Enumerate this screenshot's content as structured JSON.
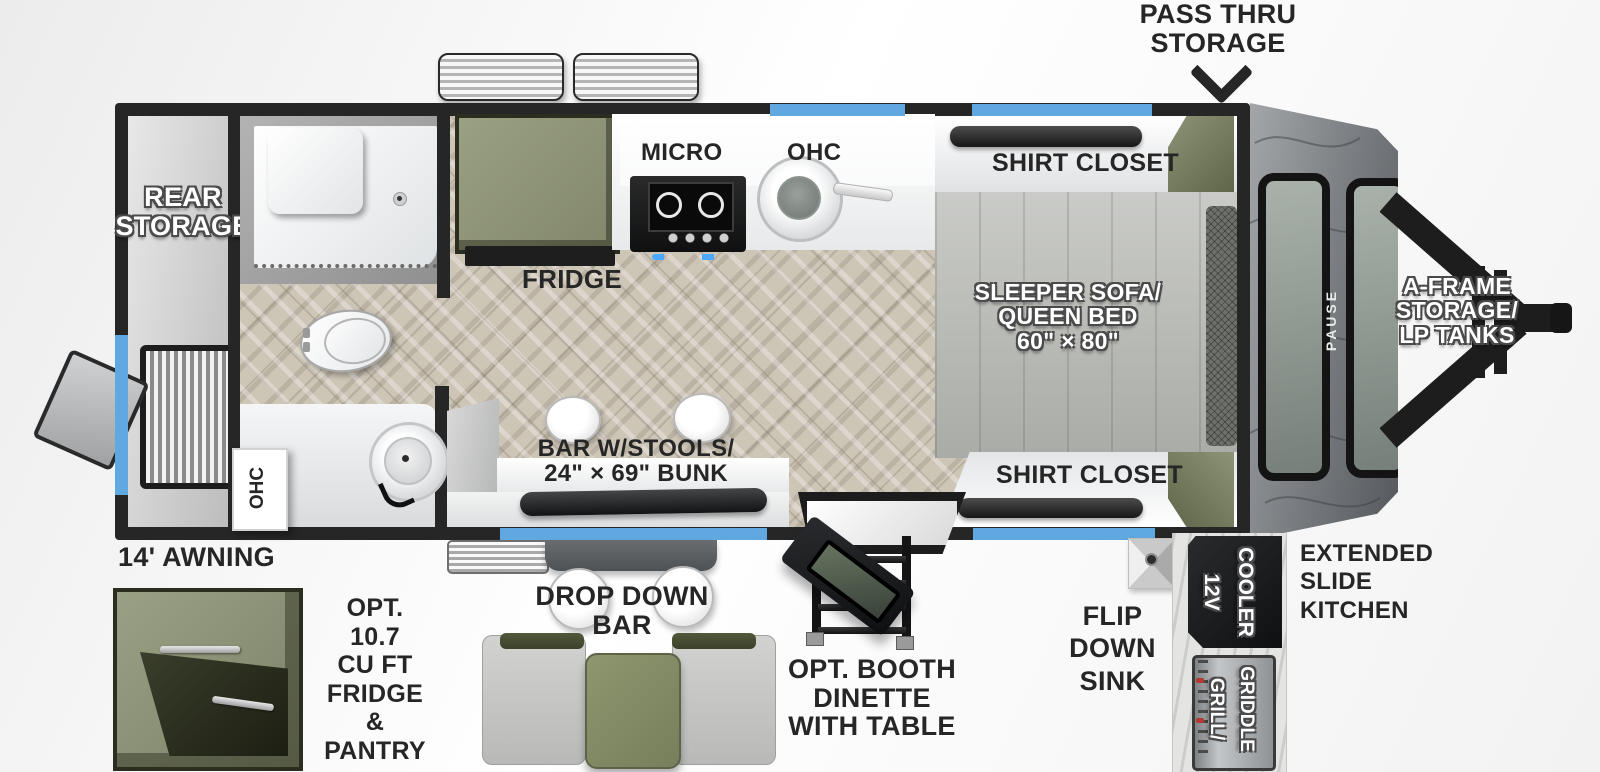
{
  "title": "Travel trailer floor plan",
  "labels": {
    "pass_thru": {
      "l1": "PASS THRU",
      "l2": "STORAGE"
    },
    "rear_storage": {
      "l1": "REAR",
      "l2": "STORAGE"
    },
    "micro": "MICRO",
    "ohc_kitchen": "OHC",
    "ohc_rear": "OHC",
    "fridge": "FRIDGE",
    "shirt_closet_top": "SHIRT CLOSET",
    "shirt_closet_bottom": "SHIRT CLOSET",
    "sleeper": {
      "l1": "SLEEPER SOFA/",
      "l2": "QUEEN BED",
      "l3": "60\" × 80\""
    },
    "a_frame": {
      "l1": "A-FRAME",
      "l2": "STORAGE/",
      "l3": "LP TANKS"
    },
    "bar_bunk": {
      "l1": "BAR W/STOOLS/",
      "l2": "24\" × 69\" BUNK"
    },
    "awning": "14' AWNING",
    "opt_fridge": {
      "l1": "OPT.",
      "l2": "10.7",
      "l3": "CU FT",
      "l4": "FRIDGE",
      "l5": "&",
      "l6": "PANTRY"
    },
    "drop_down_bar": {
      "l1": "DROP DOWN",
      "l2": "BAR"
    },
    "opt_booth": {
      "l1": "OPT. BOOTH",
      "l2": "DINETTE",
      "l3": "WITH TABLE"
    },
    "flip_down_sink": {
      "l1": "FLIP",
      "l2": "DOWN",
      "l3": "SINK"
    },
    "cooler_12v": {
      "l1": "12V",
      "l2": "COOLER"
    },
    "grill_griddle": {
      "l1": "GRILL/",
      "l2": "GRIDDLE"
    },
    "extended_slide": {
      "l1": "EXTENDED",
      "l2": "SLIDE",
      "l3": "KITCHEN"
    },
    "brand": "PAUSE"
  },
  "colors": {
    "accent_blue": "#5fa8e0",
    "olive_green": "#8e9379",
    "dark_olive": "#3c4129",
    "wall_black": "#262626",
    "floor_tan": "#cdc5b6",
    "cap_gray": "#7e8185",
    "label_dark": "#262626",
    "label_white": "#ffffff"
  }
}
